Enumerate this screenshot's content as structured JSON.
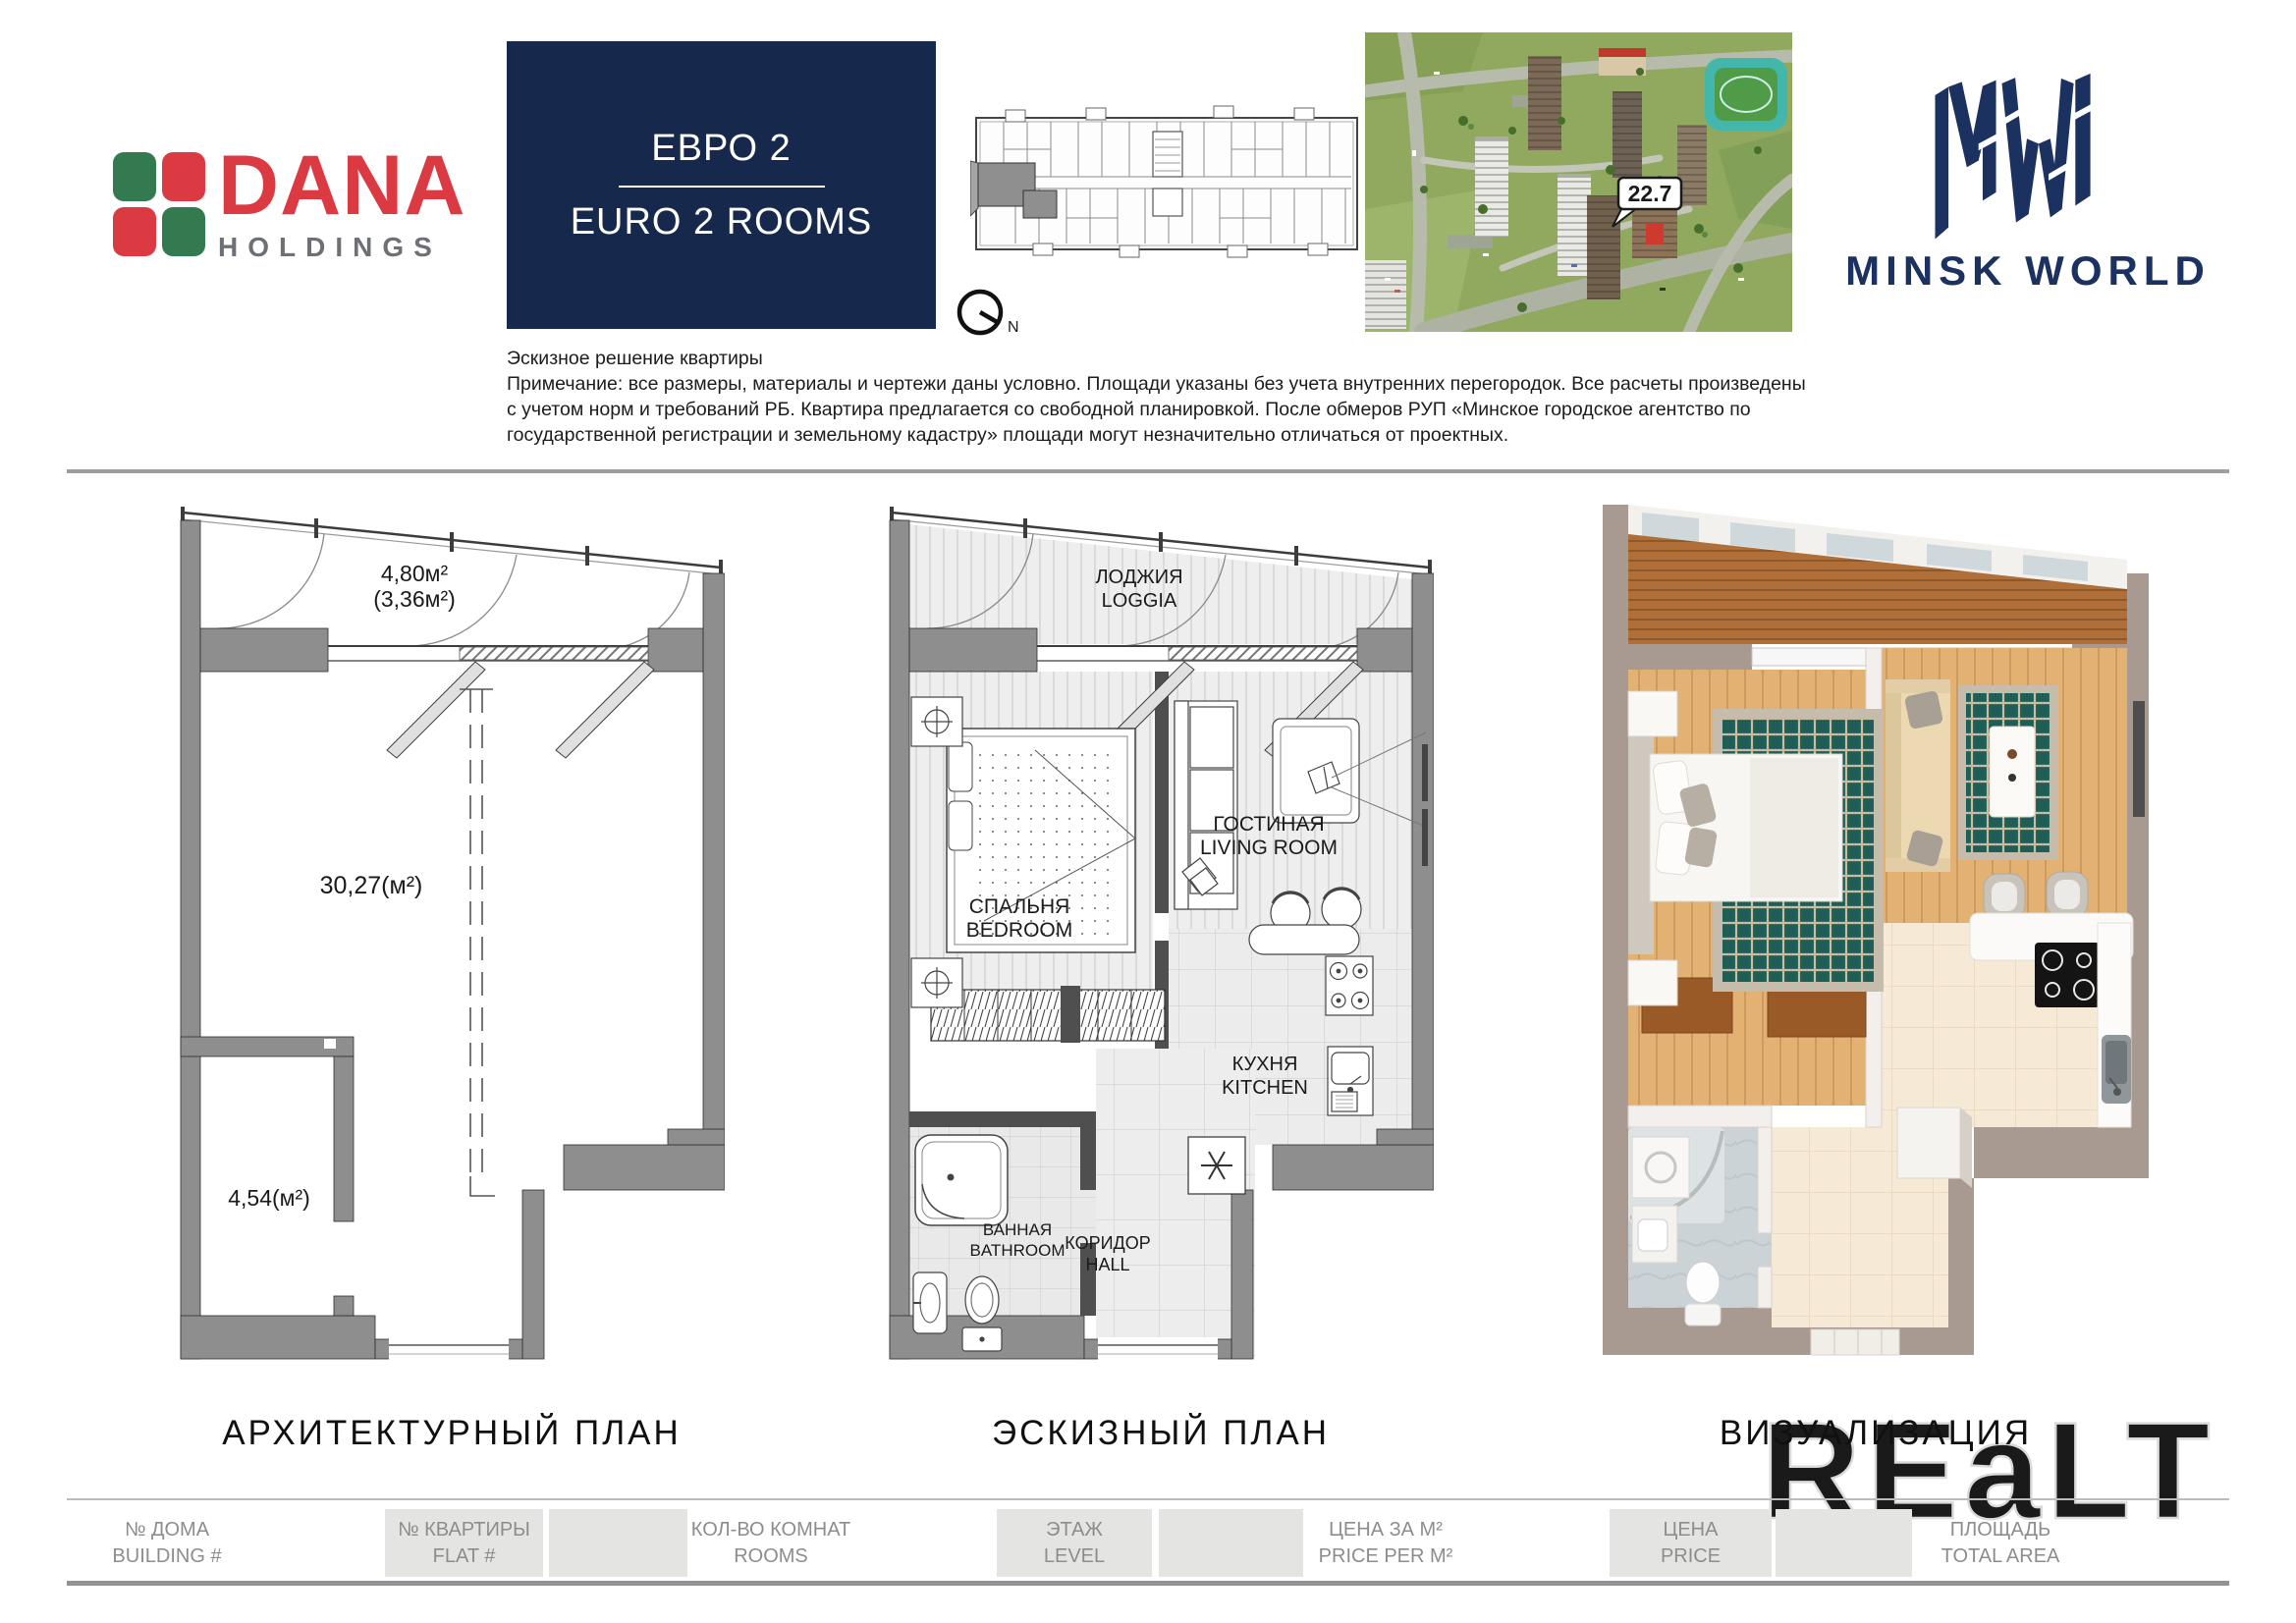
{
  "brand": {
    "dana_line1": "DANA",
    "dana_line2": "HOLDINGS",
    "minsk_world": "MINSK WORLD"
  },
  "unit_type": {
    "ru": "ЕВРО 2",
    "en": "EURO 2 ROOMS"
  },
  "compass": {
    "north": "N"
  },
  "site_map": {
    "callout": "22.7"
  },
  "note": {
    "line1": "Эскизное решение квартиры",
    "line2": "Примечание: все размеры, материалы и чертежи даны условно. Площади указаны без учета внутренних перегородок. Все расчеты произведены",
    "line3": "с учетом норм и требований РБ. Квартира предлагается со свободной планировкой. После обмеров РУП «Минское городское агентство по",
    "line4": "государственной регистрации и земельному кадастру» площади могут незначительно отличаться от проектных."
  },
  "architectural_plan": {
    "title": "АРХИТЕКТУРНЫЙ ПЛАН",
    "balcony_area": "4,80м²",
    "balcony_area_reduced": "(3,36м²)",
    "main_area": "30,27(м²)",
    "storage_area": "4,54(м²)"
  },
  "sketch_plan": {
    "title": "ЭСКИЗНЫЙ ПЛАН",
    "loggia_ru": "ЛОДЖИЯ",
    "loggia_en": "LOGGIA",
    "bedroom_ru": "СПАЛЬНЯ",
    "bedroom_en": "BEDROOM",
    "living_ru": "ГОСТИНАЯ",
    "living_en": "LIVING ROOM",
    "kitchen_ru": "КУХНЯ",
    "kitchen_en": "KITCHEN",
    "bathroom_ru": "ВАННАЯ",
    "bathroom_en": "BATHROOM",
    "hall_ru": "КОРИДОР",
    "hall_en": "HALL"
  },
  "visualization": {
    "title": "ВИЗУАЛИЗАЦИЯ"
  },
  "watermark": "REaLT",
  "footer": {
    "cells": [
      {
        "ru": "№ ДОМА",
        "en": "BUILDING #"
      },
      {
        "ru": "№ КВАРТИРЫ",
        "en": "FLAT #"
      },
      {
        "ru": "КОЛ-ВО КОМНАТ",
        "en": "ROOMS"
      },
      {
        "ru": "ЭТАЖ",
        "en": "LEVEL"
      },
      {
        "ru": "ЦЕНА ЗА М²",
        "en": "PRICE PER M²"
      },
      {
        "ru": "ЦЕНА",
        "en": "PRICE"
      },
      {
        "ru": "ПЛОЩАДЬ",
        "en": "TOTAL AREA"
      }
    ]
  },
  "colors": {
    "navy": "#16294c",
    "mw_navy": "#1b3160",
    "dana_red": "#dc3a43",
    "dana_green": "#337a50",
    "dana_gray": "#6d7175",
    "wall_gray": "#8e8e8e",
    "footer_box": "#e4e4e2",
    "rug_teal": "#1f5e56"
  }
}
